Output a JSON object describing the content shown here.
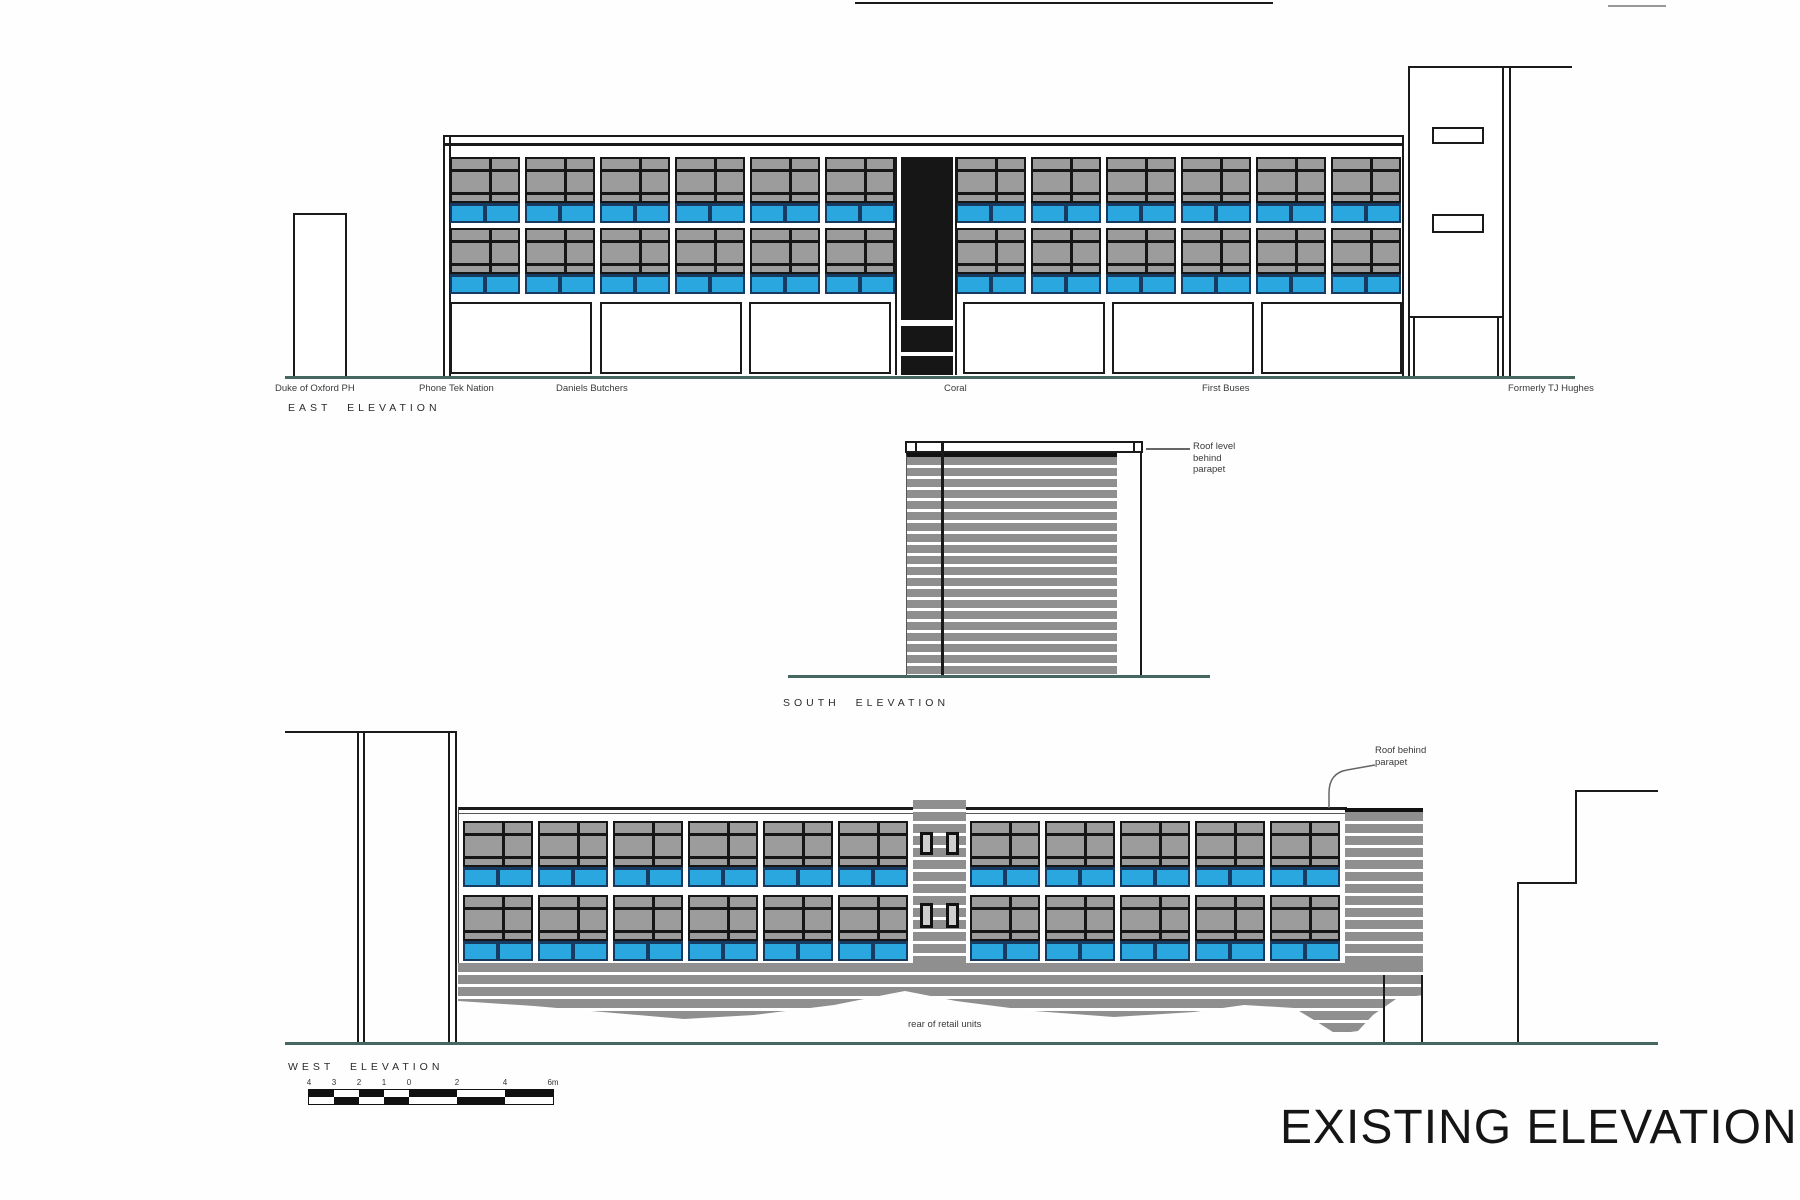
{
  "sheet_title": "EXISTING ELEVATIONS",
  "east": {
    "label": "EAST ELEVATION",
    "bays_left": 6,
    "bays_right": 6,
    "unit_labels": [
      "Duke of Oxford PH",
      "Phone Tek Nation",
      "Daniels Butchers",
      "Coral",
      "First Buses",
      "Formerly TJ Hughes"
    ]
  },
  "south": {
    "label": "SOUTH ELEVATION",
    "annotation": "Roof level\nbehind\nparapet"
  },
  "west": {
    "label": "WEST ELEVATION",
    "annotation": "Roof behind\nparapet",
    "note": "rear of retail units",
    "bays_left": 6,
    "bays_right": 5
  },
  "scale_bar": {
    "tick_labels": [
      "4",
      "3",
      "2",
      "1",
      "0",
      "2",
      "4",
      "6m"
    ]
  },
  "colors": {
    "window_gray": "#9c9c9c",
    "mullion_black": "#161616",
    "panel_blue": "#29a7de",
    "panel_navy": "#173a60",
    "louvre_gray": "#8f8f8f",
    "ground_teal": "#44685f",
    "line_black": "#1a1a1a"
  }
}
